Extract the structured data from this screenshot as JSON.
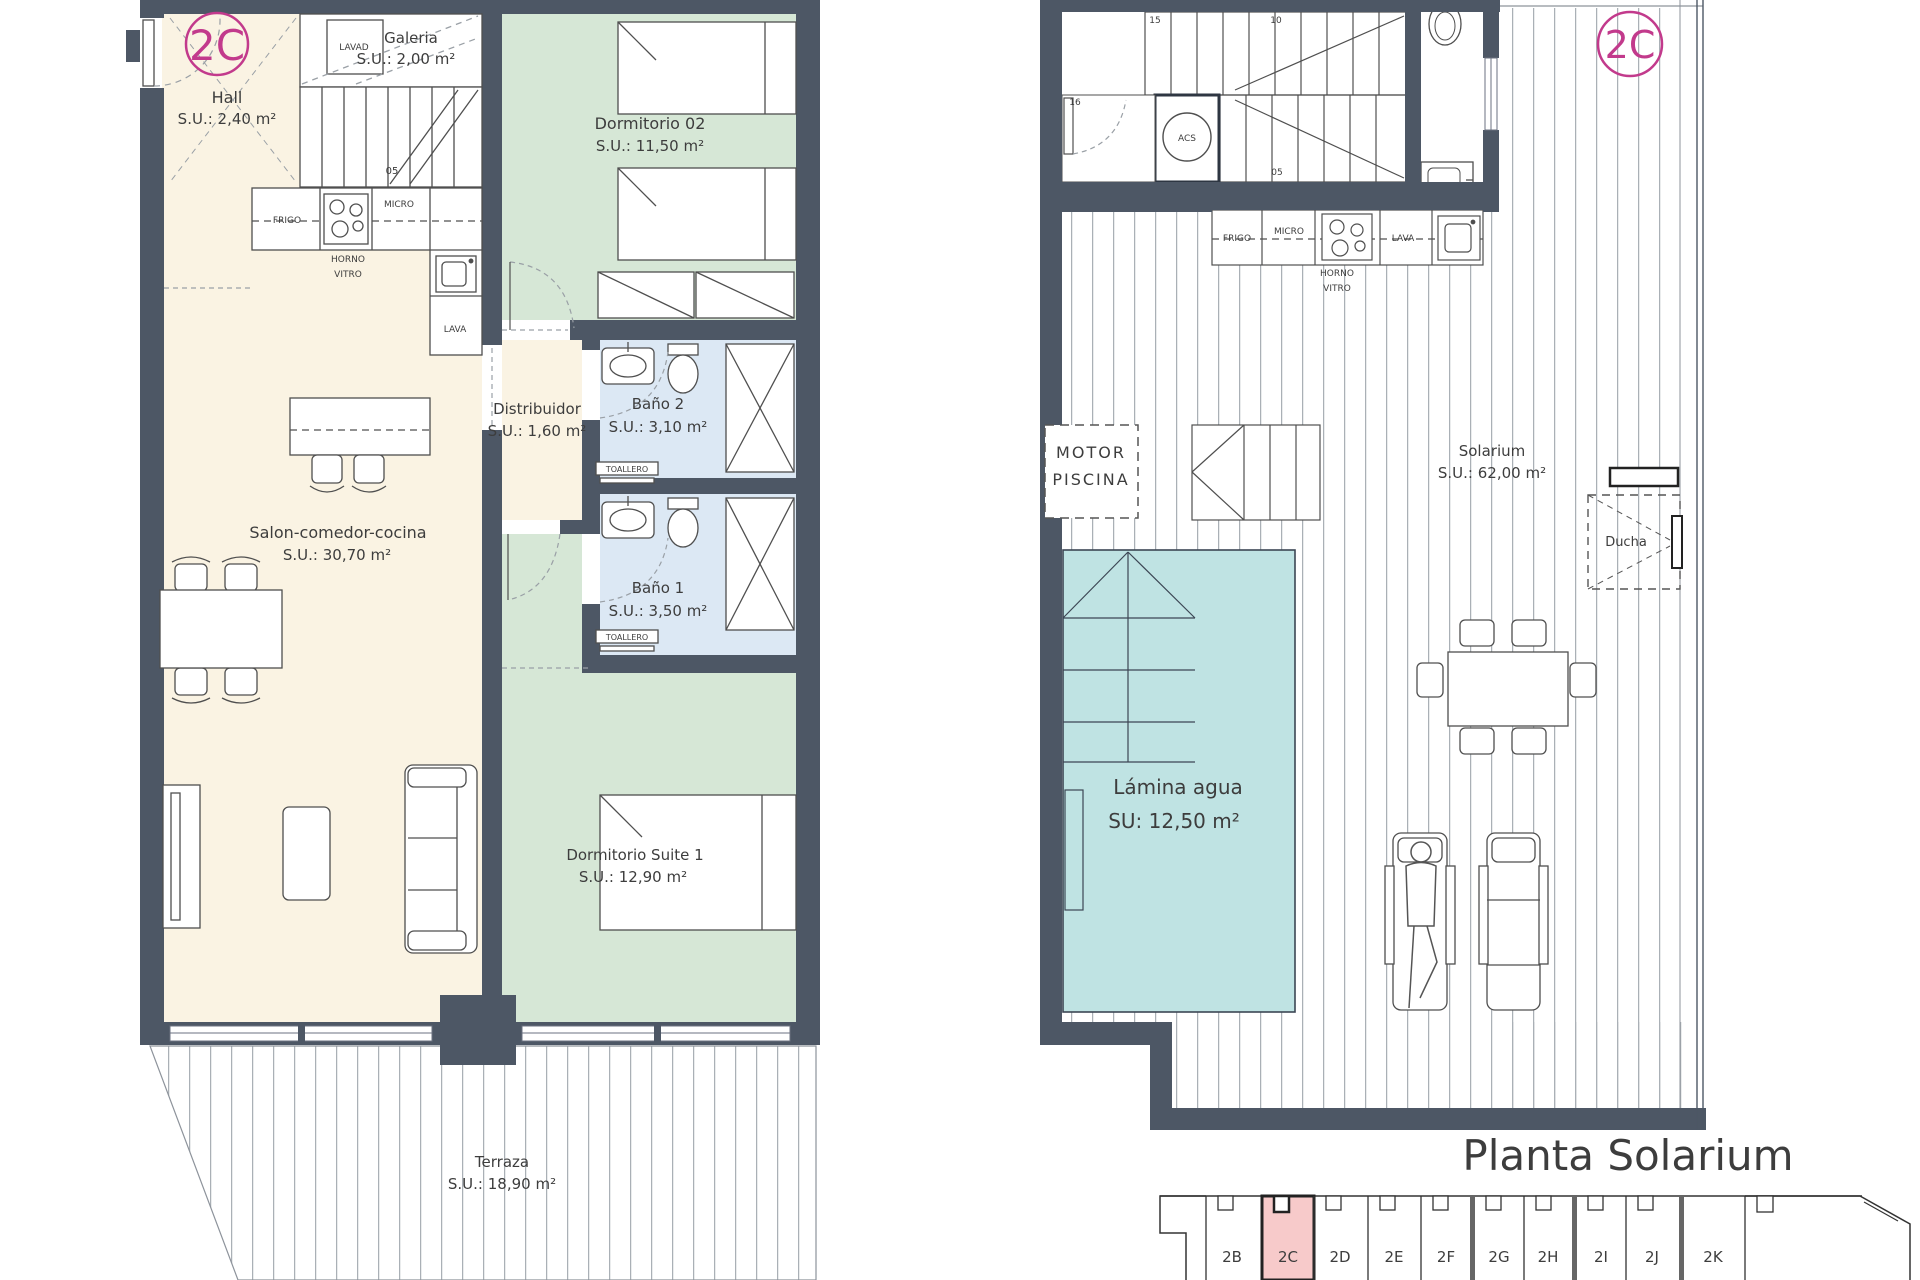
{
  "unit": "2C",
  "title": "Planta Solarium",
  "colors": {
    "wall": "#4d5765",
    "cream": "#faf3e3",
    "green": "#d6e7d6",
    "bath_blue": "#dce8f4",
    "pool_teal": "#bfe3e3",
    "highlight_pink": "#f7caca",
    "accent_magenta": "#c23a8c"
  },
  "left": {
    "badge": "2C",
    "hall": {
      "name": "Hall",
      "area": "S.U.: 2,40 m²"
    },
    "galeria": {
      "name": "Galeria",
      "area": "S.U.: 2,00 m²",
      "appliance": "LAVAD"
    },
    "stair_step": "05",
    "kitchen": {
      "frigo": "FRIGO",
      "micro": "MICRO",
      "horno": "HORNO",
      "vitro": "VITRO",
      "lava": "LAVA"
    },
    "dormitorio02": {
      "name": "Dormitorio 02",
      "area": "S.U.: 11,50 m²"
    },
    "distribuidor": {
      "name": "Distribuidor",
      "area": "S.U.: 1,60 m²"
    },
    "bano2": {
      "name": "Baño 2",
      "area": "S.U.: 3,10 m²",
      "toallero": "TOALLERO"
    },
    "bano1": {
      "name": "Baño 1",
      "area": "S.U.: 3,50 m²",
      "toallero": "TOALLERO"
    },
    "salon": {
      "name": "Salon-comedor-cocina",
      "area": "S.U.: 30,70 m²"
    },
    "suite": {
      "name": "Dormitorio Suite 1",
      "area": "S.U.: 12,90 m²"
    },
    "terraza": {
      "name": "Terraza",
      "area": "S.U.: 18,90 m²"
    }
  },
  "right": {
    "badge": "2C",
    "stairs": {
      "s16": "16",
      "s15": "15",
      "s10": "10",
      "s05": "05"
    },
    "acs": "ACS",
    "kitchen": {
      "frigo": "FRIGO",
      "micro": "MICRO",
      "horno": "HORNO",
      "vitro": "VITRO",
      "lava": "LAVA"
    },
    "motor": {
      "line1": "MOTOR",
      "line2": "PISCINA"
    },
    "solarium": {
      "name": "Solarium",
      "area": "S.U.: 62,00 m²"
    },
    "ducha": {
      "name": "Ducha"
    },
    "pool": {
      "name": "Lámina agua",
      "area": "SU:  12,50 m²"
    }
  },
  "locator": {
    "units": [
      "2B",
      "2C",
      "2D",
      "2E",
      "2F",
      "2G",
      "2H",
      "2I",
      "2J",
      "2K"
    ],
    "highlighted": "2C"
  }
}
